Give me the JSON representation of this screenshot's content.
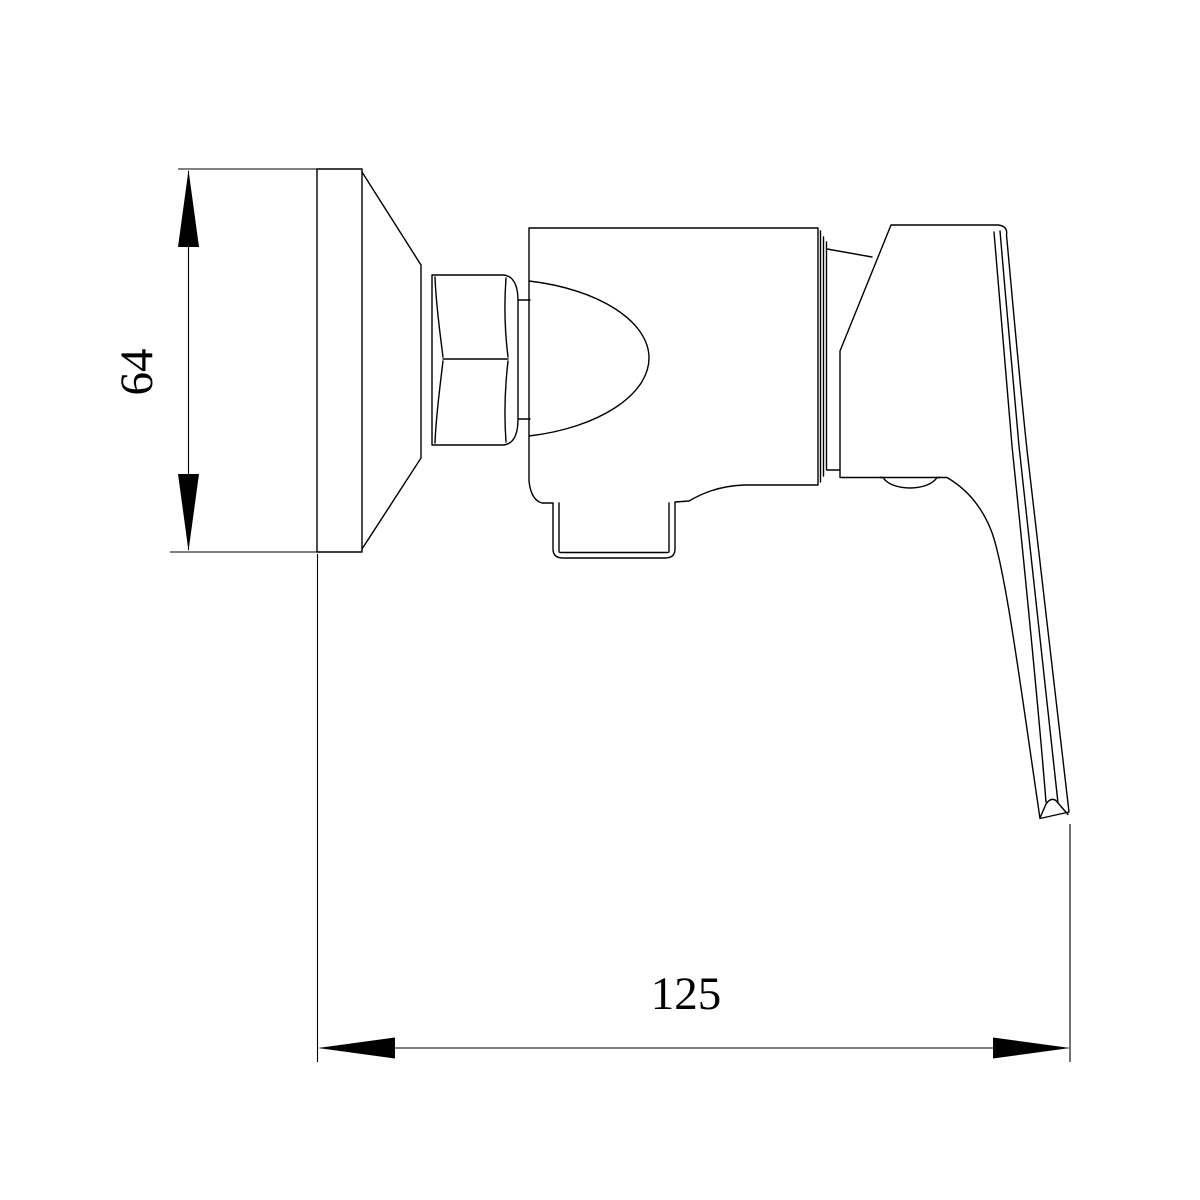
{
  "drawing": {
    "subject": "shower-mixer-valve-side-view",
    "background_color": "#ffffff",
    "line_color": "#000000",
    "dimensions": {
      "height": {
        "label": "64"
      },
      "width": {
        "label": "125"
      }
    }
  }
}
